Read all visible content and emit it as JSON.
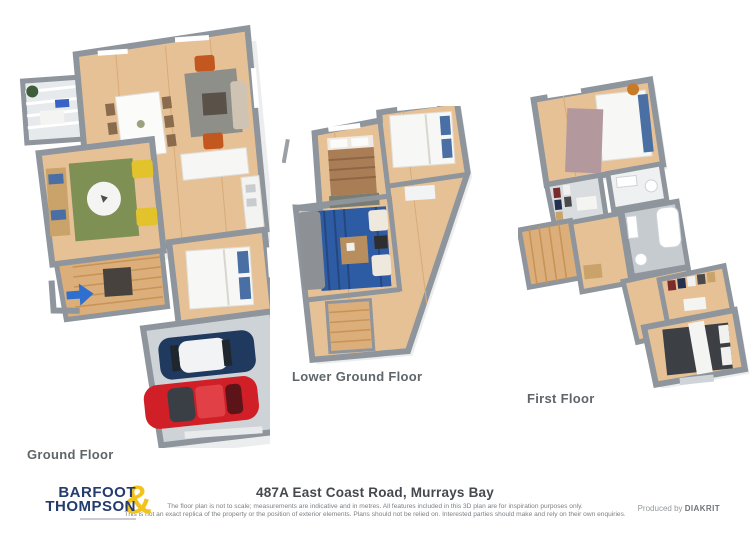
{
  "floors": [
    {
      "label": "Ground Floor"
    },
    {
      "label": "Lower Ground Floor"
    },
    {
      "label": "First Floor"
    }
  ],
  "footer": {
    "logo": {
      "line1": "BARFOOT",
      "line2": "THOMPSON",
      "ampersand": "&"
    },
    "address": "487A East Coast Road, Murrays Bay",
    "disclaimer_line1": "The floor plan is not to scale; measurements are indicative and in metres. All features included in this 3D plan are for inspiration purposes only.",
    "disclaimer_line2": "This is not an exact replica of the property or the position of exterior elements. Plans should not be relied on. Interested parties should make and rely on their own enquiries.",
    "produced_by": "Produced by",
    "producer_brand": "DIAKRIT"
  },
  "colors": {
    "brand_navy": "#233b6d",
    "brand_gold": "#f2c31c",
    "wall_gray": "#8e959c",
    "floor_wood": "#e6c196",
    "garage_floor": "#ced3d8",
    "rug_green": "#7f9055",
    "rug_blue": "#2e5ca4",
    "rug_gray": "#8f8f8a",
    "rug_mauve": "#b3989e",
    "car_red": "#d01f26",
    "car_blue": "#1f3a5e",
    "chair_yellow": "#e3c32c",
    "chair_orange": "#c2571f",
    "arrow_blue": "#2f6fd0",
    "bed_white": "#f7f7f5",
    "bed_brown": "#a97e57",
    "bed_dark": "#3c3f44",
    "pillow_blue": "#4a6fa5"
  }
}
